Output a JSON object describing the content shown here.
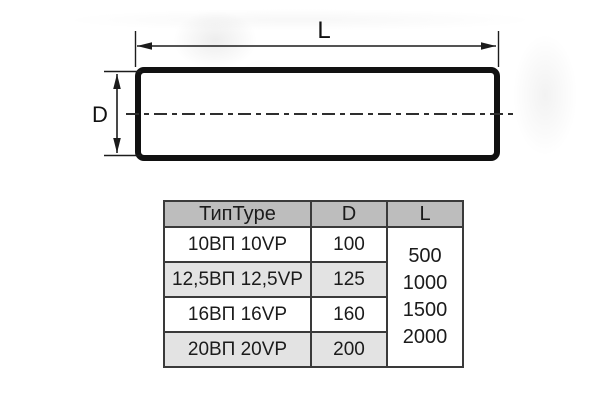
{
  "diagram": {
    "length_label": "L",
    "diameter_label": "D"
  },
  "table": {
    "headers": {
      "type": "ТипType",
      "d": "D",
      "l": "L"
    },
    "rows": [
      {
        "type": "10ВП 10VP",
        "d": "100"
      },
      {
        "type": "12,5ВП 12,5VP",
        "d": "125"
      },
      {
        "type": "16ВП 16VP",
        "d": "160"
      },
      {
        "type": "20ВП 20VP",
        "d": "200"
      }
    ],
    "l_values": [
      "500",
      "1000",
      "1500",
      "2000"
    ]
  },
  "colors": {
    "header_bg": "#bdbdbd",
    "row_alt_bg": "#e3e3e3",
    "table_border": "#3a3a3a",
    "ink": "#1b1b1b",
    "duct_outline": "#111111"
  }
}
